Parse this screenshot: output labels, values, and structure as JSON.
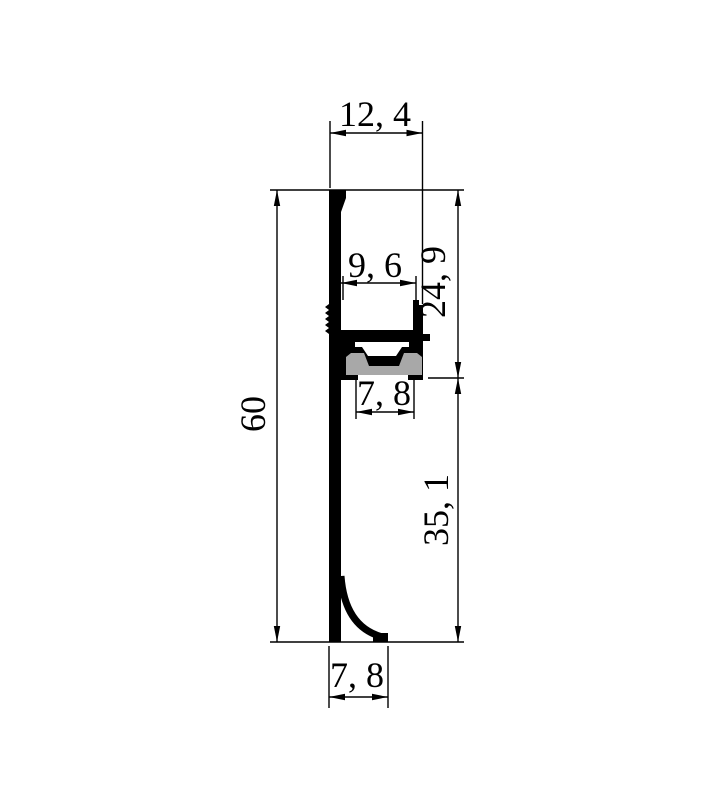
{
  "drawing": {
    "kind": "aluminum-profile-cross-section",
    "description": "2D CAD dimension drawing of an LED skirting profile cross-section with gray diffuser insert and coved foot",
    "background_color": "#ffffff",
    "line_color": "#000000",
    "solid_fill_color": "#000000",
    "diffuser_color": "#a8a8a8",
    "decimal_style": "comma",
    "dimensions": {
      "overall_width": {
        "label": "12, 4",
        "value": 12.4,
        "orientation": "horizontal",
        "position": "top"
      },
      "channel_width": {
        "label": "9, 6",
        "value": 9.6,
        "orientation": "horizontal",
        "position": "middle"
      },
      "upper_height": {
        "label": "24, 9",
        "value": 24.9,
        "orientation": "vertical",
        "position": "right-upper"
      },
      "slot_width": {
        "label": "7, 8",
        "value": 7.8,
        "orientation": "horizontal",
        "position": "below-channel"
      },
      "overall_height": {
        "label": "60",
        "value": 60,
        "orientation": "vertical",
        "position": "left"
      },
      "lower_height": {
        "label": "35, 1",
        "value": 35.1,
        "orientation": "vertical",
        "position": "right-lower"
      },
      "foot_width": {
        "label": "7, 8",
        "value": 7.8,
        "orientation": "horizontal",
        "position": "bottom"
      }
    }
  }
}
